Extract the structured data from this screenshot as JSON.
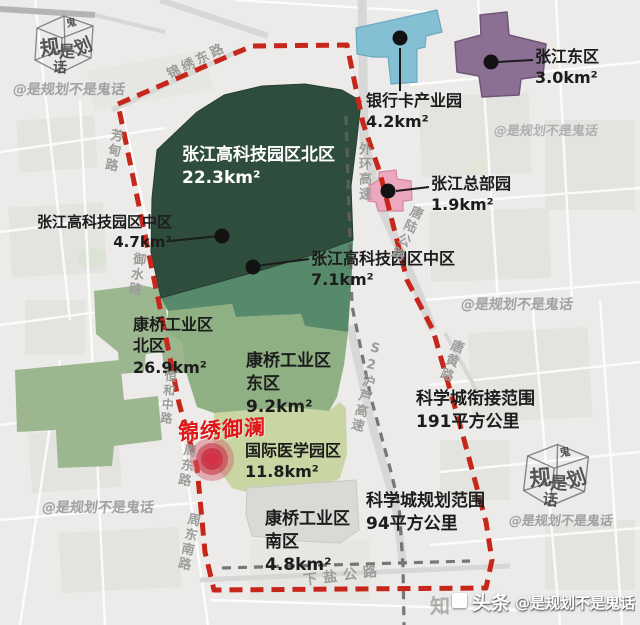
{
  "zones": [
    {
      "name": "张江高科技园区北区",
      "area": "22.3km²",
      "color": "#2f4d3d"
    },
    {
      "name": "张江高科技园区中区",
      "area": "4.7km²",
      "color": "#4f7f63"
    },
    {
      "name": "张江高科技园区中区",
      "area": "7.1km²",
      "color": "#57896b"
    },
    {
      "name": "银行卡产业园",
      "area": "4.2km²",
      "color": "#85bfd4"
    },
    {
      "name": "张江东区",
      "area": "3.0km²",
      "color": "#8c7094"
    },
    {
      "name": "张江总部园",
      "area": "1.9km²",
      "color": "#eca9bd"
    },
    {
      "name": "康桥工业区北区",
      "area": "26.9km²",
      "color": "#9cb78f"
    },
    {
      "name": "康桥工业区东区",
      "area": "9.2km²",
      "color": "#8fb083"
    },
    {
      "name": "国际医学园区",
      "area": "11.8km²",
      "color": "#c9d6a4"
    },
    {
      "name": "康桥工业区南区",
      "area": "4.8km²",
      "color": "#d9dad6"
    }
  ],
  "boundaries": [
    {
      "name": "科学城衔接范围",
      "area": "191平方公里",
      "line": "gray-dashed",
      "color": "#636361"
    },
    {
      "name": "科学城规划范围",
      "area": "94平方公里",
      "line": "red-dashed",
      "color": "#c7271b"
    }
  ],
  "poi": {
    "name": "锦绣御澜",
    "color": "#e21418"
  },
  "roads": {
    "jinxiu_east": "锦绣东路",
    "fangdian": "芳甸路",
    "yushui": "御水路",
    "waihuan": "外环高速",
    "tanglu": "唐陆公路",
    "tanghuang": "唐黄路",
    "s2": "S2沪芦高速",
    "henghe": "恒和中路",
    "zhoudong": "周东路",
    "zhoudongnan": "周东南路",
    "xiayan": "下盐公路"
  },
  "watermark": {
    "handle": "@是规划不是鬼话",
    "cube": {
      "c1": "规",
      "c2": "是",
      "c3": "划",
      "c4": "话",
      "c5": "鬼"
    },
    "brand": "头条",
    "brand_ghost": "知"
  }
}
